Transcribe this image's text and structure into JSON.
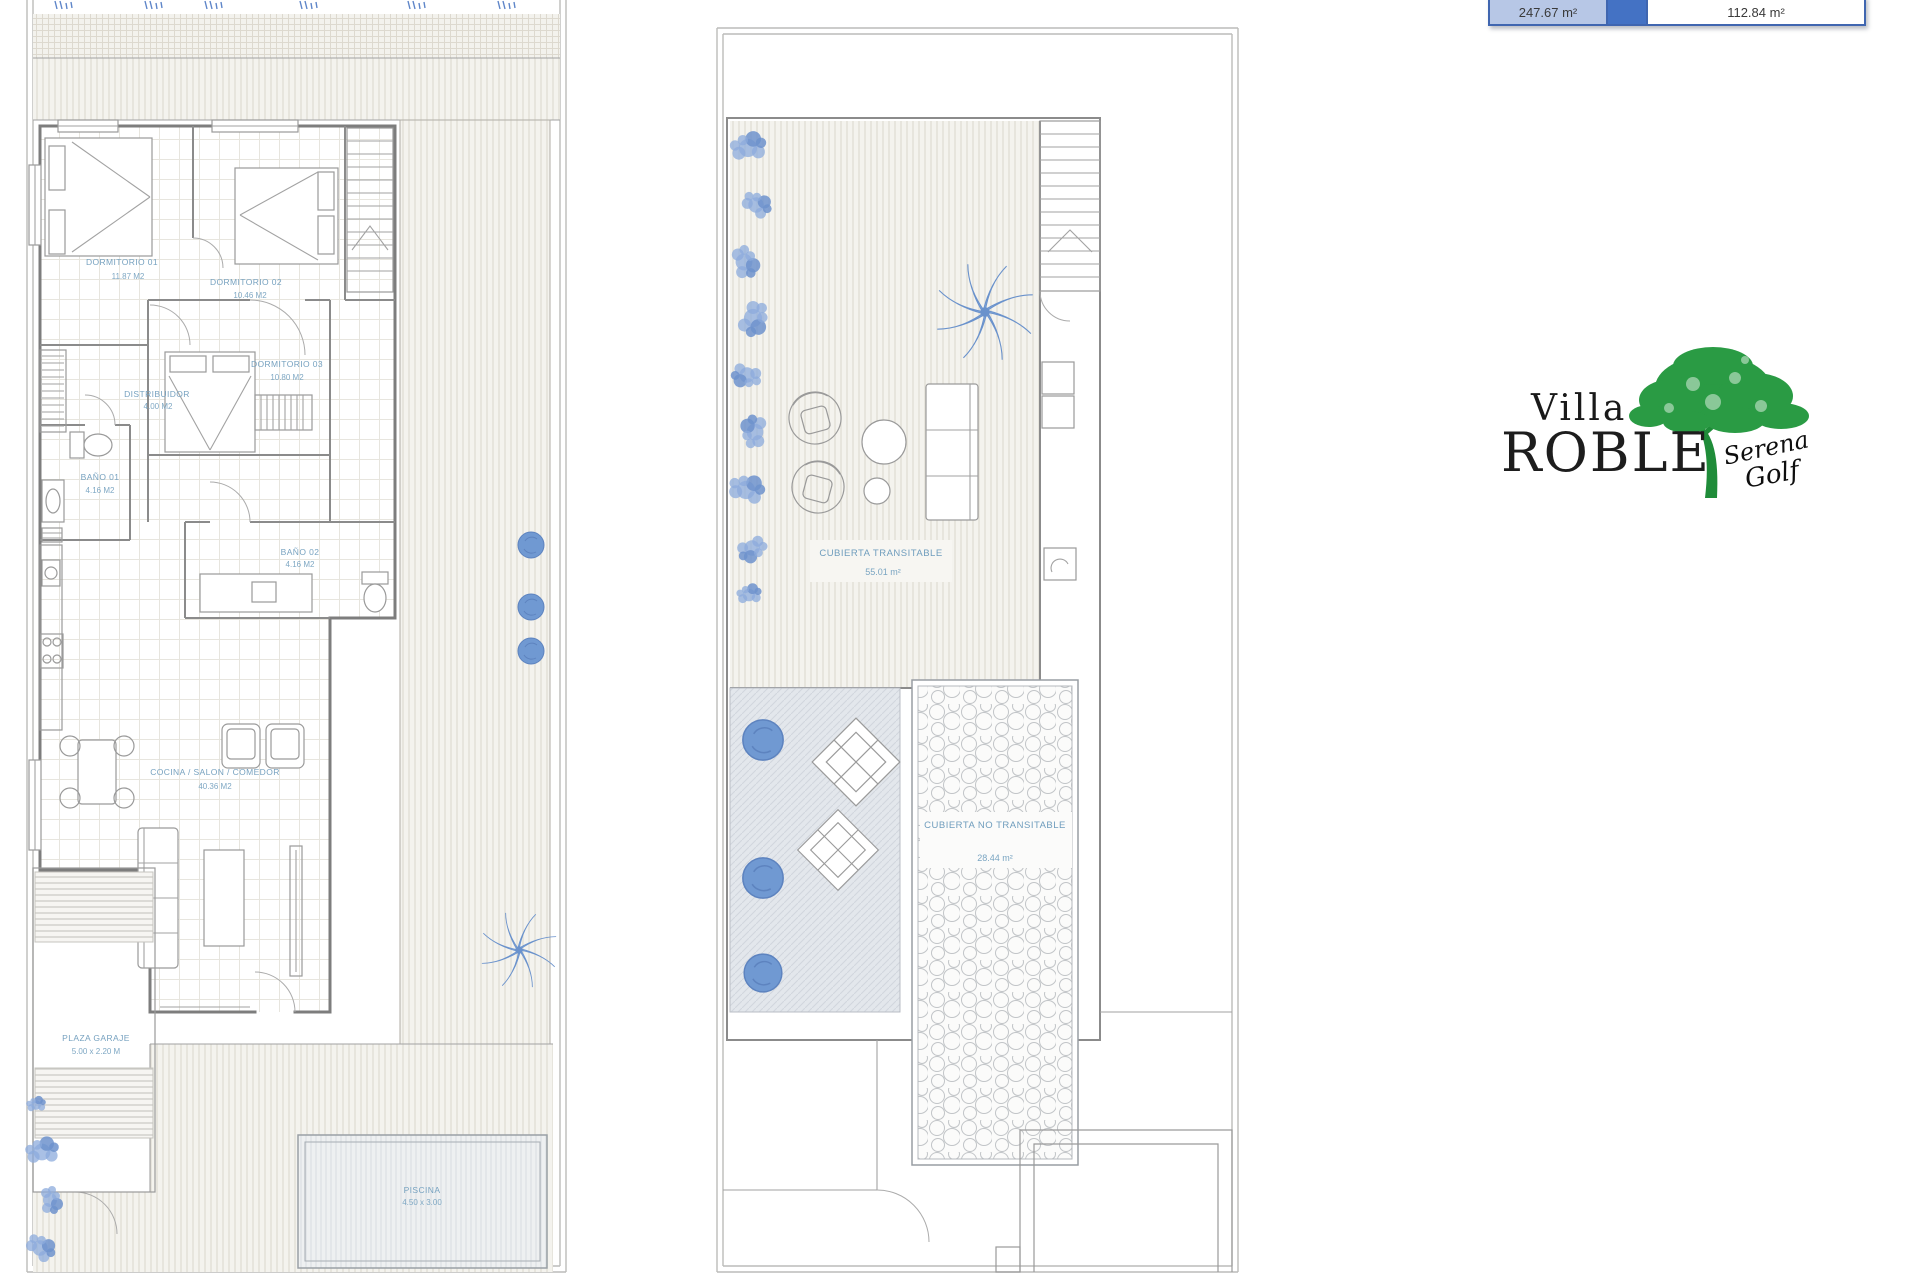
{
  "summary_table": {
    "value_left": "247.67 m²",
    "value_right": "112.84 m²"
  },
  "logo": {
    "title_top": "Villa",
    "title_main": "ROBLE",
    "script_top": "Serena",
    "script_bottom": "Golf"
  },
  "ground_floor_plan": {
    "rooms": [
      {
        "label": "DORMITORIO 01",
        "area": "11.87 M2"
      },
      {
        "label": "DORMITORIO 02",
        "area": "10.46 M2"
      },
      {
        "label": "DORMITORIO 03",
        "area": "10.80 M2"
      },
      {
        "label": "DISTRIBUIDOR",
        "area": "4.00 M2"
      },
      {
        "label": "BAÑO 01",
        "area": "4.16 M2"
      },
      {
        "label": "BAÑO 02",
        "area": "4.16 M2"
      },
      {
        "label": "COCINA / SALON / COMEDOR",
        "area": "40.36 M2"
      },
      {
        "label": "PLAZA GARAJE",
        "area": "5.00 x 2.20 M"
      },
      {
        "label": "PISCINA",
        "area": "4.50 x 3.00"
      }
    ]
  },
  "roof_plan": {
    "rooms": [
      {
        "label": "CUBIERTA TRANSITABLE",
        "area": "55.01 m²"
      },
      {
        "label": "CUBIERTA NO TRANSITABLE",
        "area": "28.44 m²"
      }
    ]
  },
  "colors": {
    "accent_blue": "#4472c4",
    "landscape_blue": "#7aa0d8",
    "tree_green": "#2a9b44",
    "label_blue": "#77a2c0"
  }
}
